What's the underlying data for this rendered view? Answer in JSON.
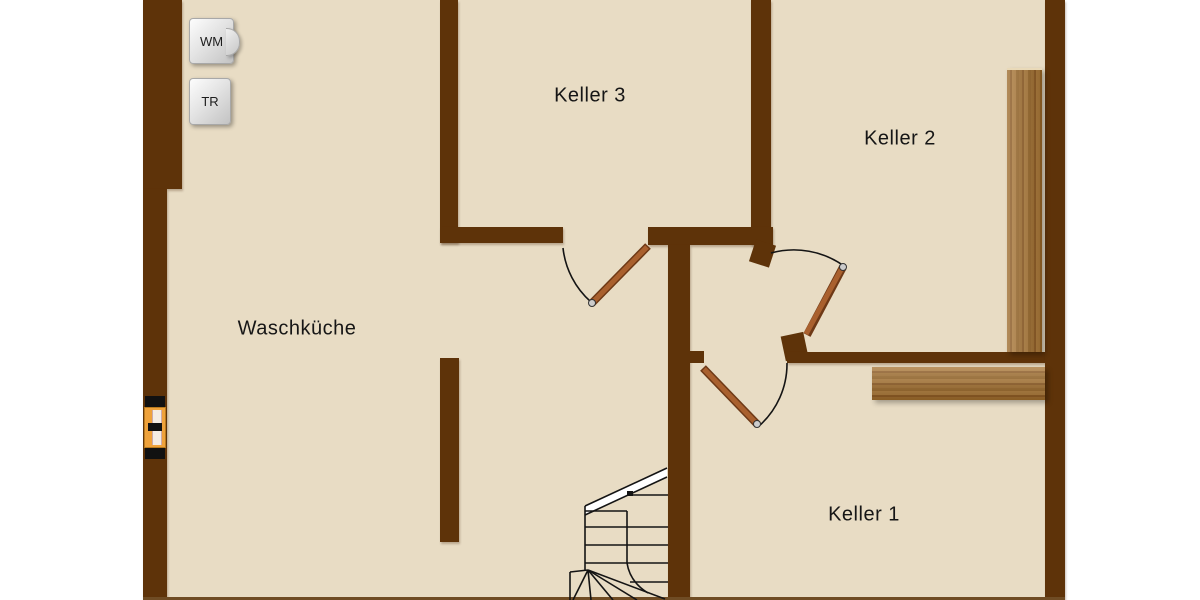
{
  "plan": {
    "type": "basement-floor-plan",
    "rooms": [
      {
        "id": "keller3",
        "label": "Keller 3"
      },
      {
        "id": "keller2",
        "label": "Keller 2"
      },
      {
        "id": "waschkueche",
        "label": "Waschküche"
      },
      {
        "id": "keller1",
        "label": "Keller 1"
      }
    ],
    "appliances": [
      {
        "id": "wm",
        "label": "WM"
      },
      {
        "id": "tr",
        "label": "TR"
      }
    ],
    "symbols": {
      "staircase": "winder-staircase-with-break-line",
      "doors": [
        "door-waschkueche-keller3",
        "door-keller2",
        "door-keller1"
      ],
      "window": "basement-window",
      "wood_panels": [
        "vertical-panel-keller2",
        "horizontal-panel-keller1"
      ]
    },
    "colors": {
      "background": "#ffffff",
      "floor": "#e8dcc4",
      "wall": "#5e3309",
      "door_leaf": "#a9602e",
      "door_arc": "#141414",
      "wood_panel": "#9c6a2b",
      "window_frame": "#efa23b",
      "appliance_box": "#dcdcdc",
      "text": "#161616"
    }
  }
}
